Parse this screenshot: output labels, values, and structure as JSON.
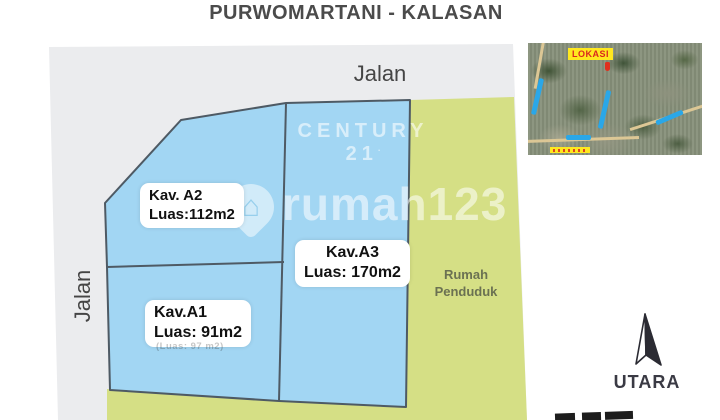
{
  "title": "PURWOMARTANI - KALASAN",
  "plan": {
    "road_top_label": "Jalan",
    "road_left_label": "Jalan",
    "neighbor_label": "Rumah\nPenduduk",
    "plots": {
      "a2": {
        "name": "Kav. A2",
        "area": "Luas:112m2"
      },
      "a3": {
        "name": "Kav.A3",
        "area": "Luas: 170m2"
      },
      "a1": {
        "name": "Kav.A1",
        "area": "Luas: 91m2",
        "old_area_ghost": "(Luas: 97 m2)"
      }
    },
    "colors": {
      "road_fill": "#ebecee",
      "plot_fill": "#a2d6f3",
      "plot_border": "#4e5a64",
      "neighbor_fill": "#d5df85"
    }
  },
  "watermarks": {
    "century21": "CENTURY 21",
    "rumah123": "rumah123"
  },
  "inset_map": {
    "location_label": "LOKASI",
    "colors": {
      "label_bg": "#ffe81f",
      "label_text": "#d9281e",
      "road_highlight": "#2aa7e8",
      "marker": "#e0301e"
    }
  },
  "compass": {
    "label": "UTARA"
  }
}
